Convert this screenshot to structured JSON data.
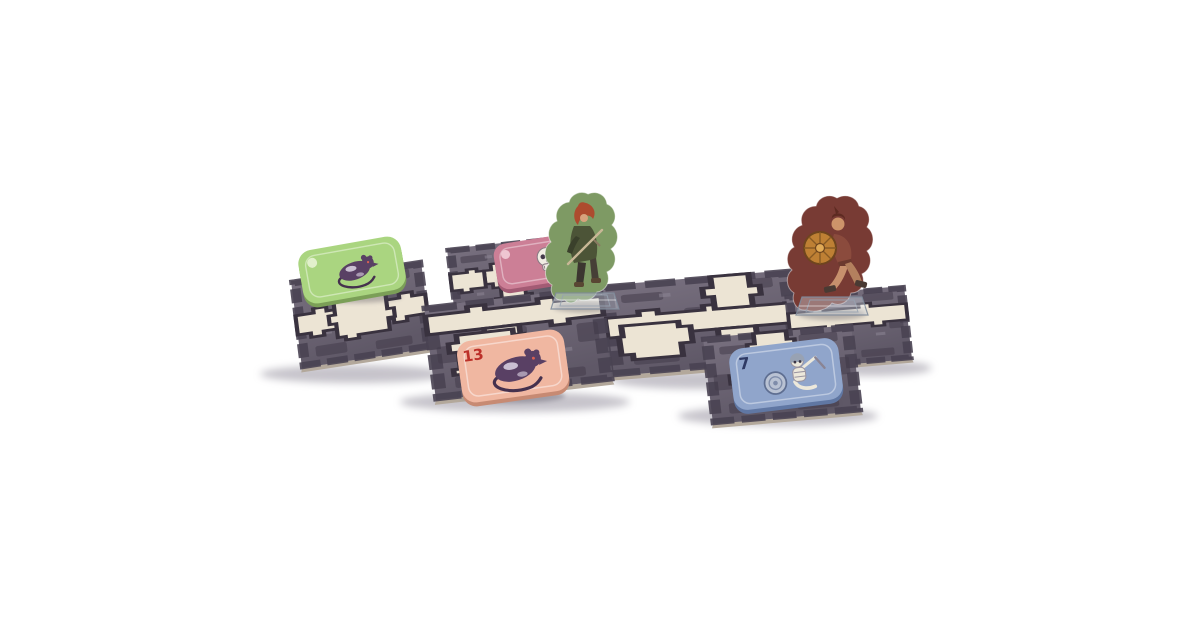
{
  "scene": {
    "background": "#ffffff"
  },
  "theme": {
    "bg": "#ffffff",
    "tilelight": "#78707f",
    "tiledark": "#5f5867",
    "stone": "#494253",
    "blotch": "#443d4d",
    "path": "#ece4d3",
    "ink": "#39323f",
    "edge": "#b3a89a",
    "shadowc": "#8d8896",
    "itemshadow": "#4a4455",
    "rat": "#5a4065",
    "ratdark": "#46314f"
  },
  "board": {
    "tiles": [
      {
        "name": "tile-back-left"
      },
      {
        "name": "tile-corridor-middle"
      },
      {
        "name": "tile-back-right"
      },
      {
        "name": "tile-cross-left"
      },
      {
        "name": "tile-room-front"
      },
      {
        "name": "tile-room-right"
      }
    ]
  },
  "tokens": [
    {
      "name": "monster-token-green",
      "creature": "rat-icon",
      "fill": "#a9d67d",
      "edge": "#7aa055"
    },
    {
      "name": "monster-token-pink",
      "creature": "skull-icon",
      "fill": "#ce7e96",
      "edge": "#a55a74"
    },
    {
      "name": "monster-token-salmon",
      "creature": "rat-icon",
      "fill": "#f2b7a0",
      "edge": "#c98a72",
      "number": "13",
      "number_color": "#c13028"
    },
    {
      "name": "monster-token-blue",
      "creature": "skeleton-knight-icon",
      "fill": "#8fa5cd",
      "edge": "#5f77a5",
      "number": "7",
      "number_color": "#2e3a66"
    }
  ],
  "standees": [
    {
      "name": "hero-standee-green",
      "figure": "ranger-figure",
      "fill": "#7d9a62"
    },
    {
      "name": "hero-standee-maroon",
      "figure": "warrior-figure",
      "fill": "#7a3a33"
    }
  ]
}
